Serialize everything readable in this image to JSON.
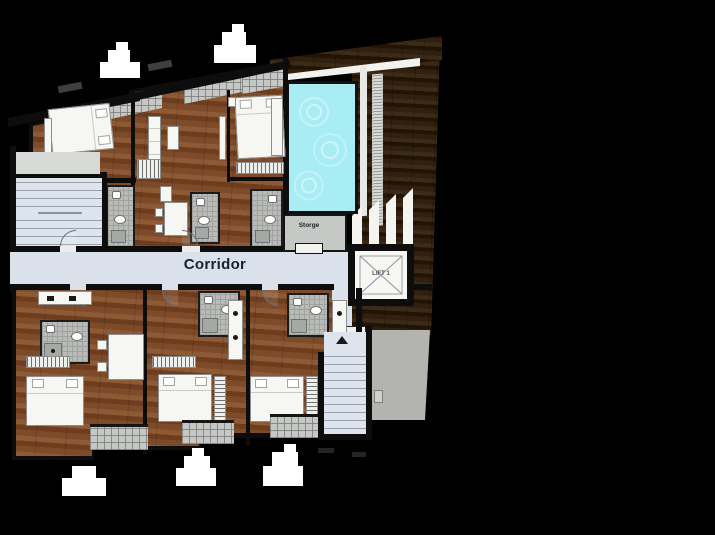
{
  "labels": {
    "corridor": "Corridor",
    "storage": "Storge",
    "lift": "LIFT 1"
  },
  "icons": {
    "lift_cross": "lift-x-icon",
    "trees": "tree-icon",
    "stairs": "stair-treads-icon"
  },
  "colors": {
    "bg": "#000000",
    "wall": "#0d0d0d",
    "wood1": "#7d4b29",
    "wood2": "#6d3d1e",
    "wood3": "#8d5a35",
    "deck1": "#31200f",
    "deck2": "#221404",
    "deck3": "#3d2b19",
    "pool": "#a8ecf4",
    "corridor": "#dbe1ea",
    "stair": "#dde4ee",
    "tile": "#b9bbb8",
    "tileLine": "#a0a2a0",
    "balcony": "#c6c8c5",
    "terrace": "#b3b3af",
    "paper": "#f6f6f3",
    "furnline": "#8d8d8b",
    "navy": "#17212f"
  }
}
